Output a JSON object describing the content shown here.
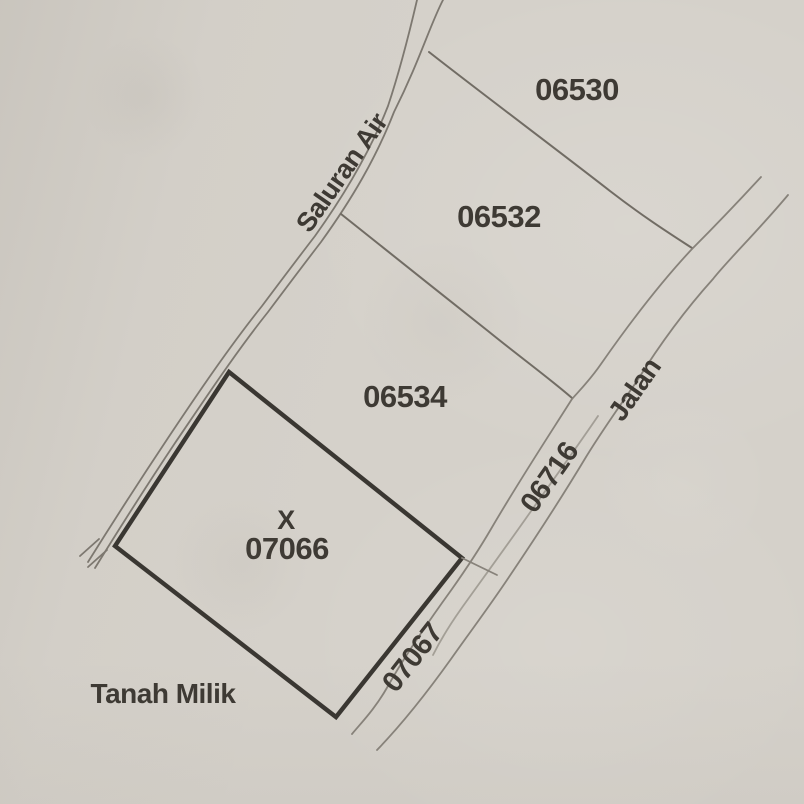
{
  "map": {
    "parcels": [
      {
        "number": "06530"
      },
      {
        "number": "06532"
      },
      {
        "number": "06534"
      },
      {
        "number": "07066",
        "marker": "X"
      },
      {
        "number": "06716"
      },
      {
        "number": "07067"
      }
    ],
    "labels": {
      "water_channel": "Saluran Air",
      "road": "Jalan",
      "ownership": "Tanah Milik"
    },
    "colors": {
      "paper": "#d5d1ca",
      "thin_line": "#87827a",
      "bold_line": "#3a3732",
      "text": "#3e3a34"
    }
  }
}
